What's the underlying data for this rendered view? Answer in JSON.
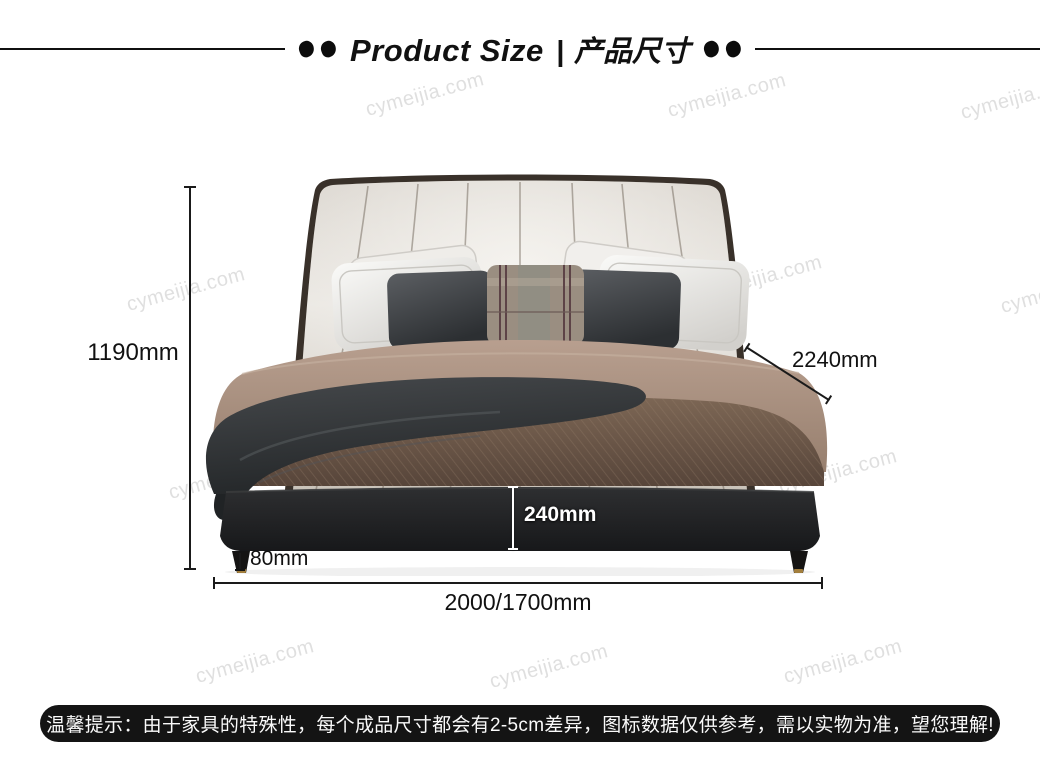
{
  "title": {
    "en": "Product Size",
    "divider": "|",
    "cn": "产品尺寸"
  },
  "watermark": {
    "text": "cymeijia.com"
  },
  "dimensions": {
    "height": "1190mm",
    "width": "2000/1700mm",
    "diagonal_depth": "2240mm",
    "frame_thickness": "240mm",
    "leg_height": "80mm"
  },
  "notice": {
    "text": "温馨提示：由于家具的特殊性，每个成品尺寸都会有2-5cm差异，图标数据仅供参考，需以实物为准，望您理解!"
  },
  "colors": {
    "dimension_line": "#1a1a1a",
    "banner_background": "#141414",
    "banner_text": "#fafafa",
    "watermark_gray": "#cdcdcd",
    "frame_label_text": "#ffffff",
    "headboard_light": "#e8e5e0",
    "base_dark": "#1f2022",
    "leg_gold_tip": "#a27e3c"
  }
}
